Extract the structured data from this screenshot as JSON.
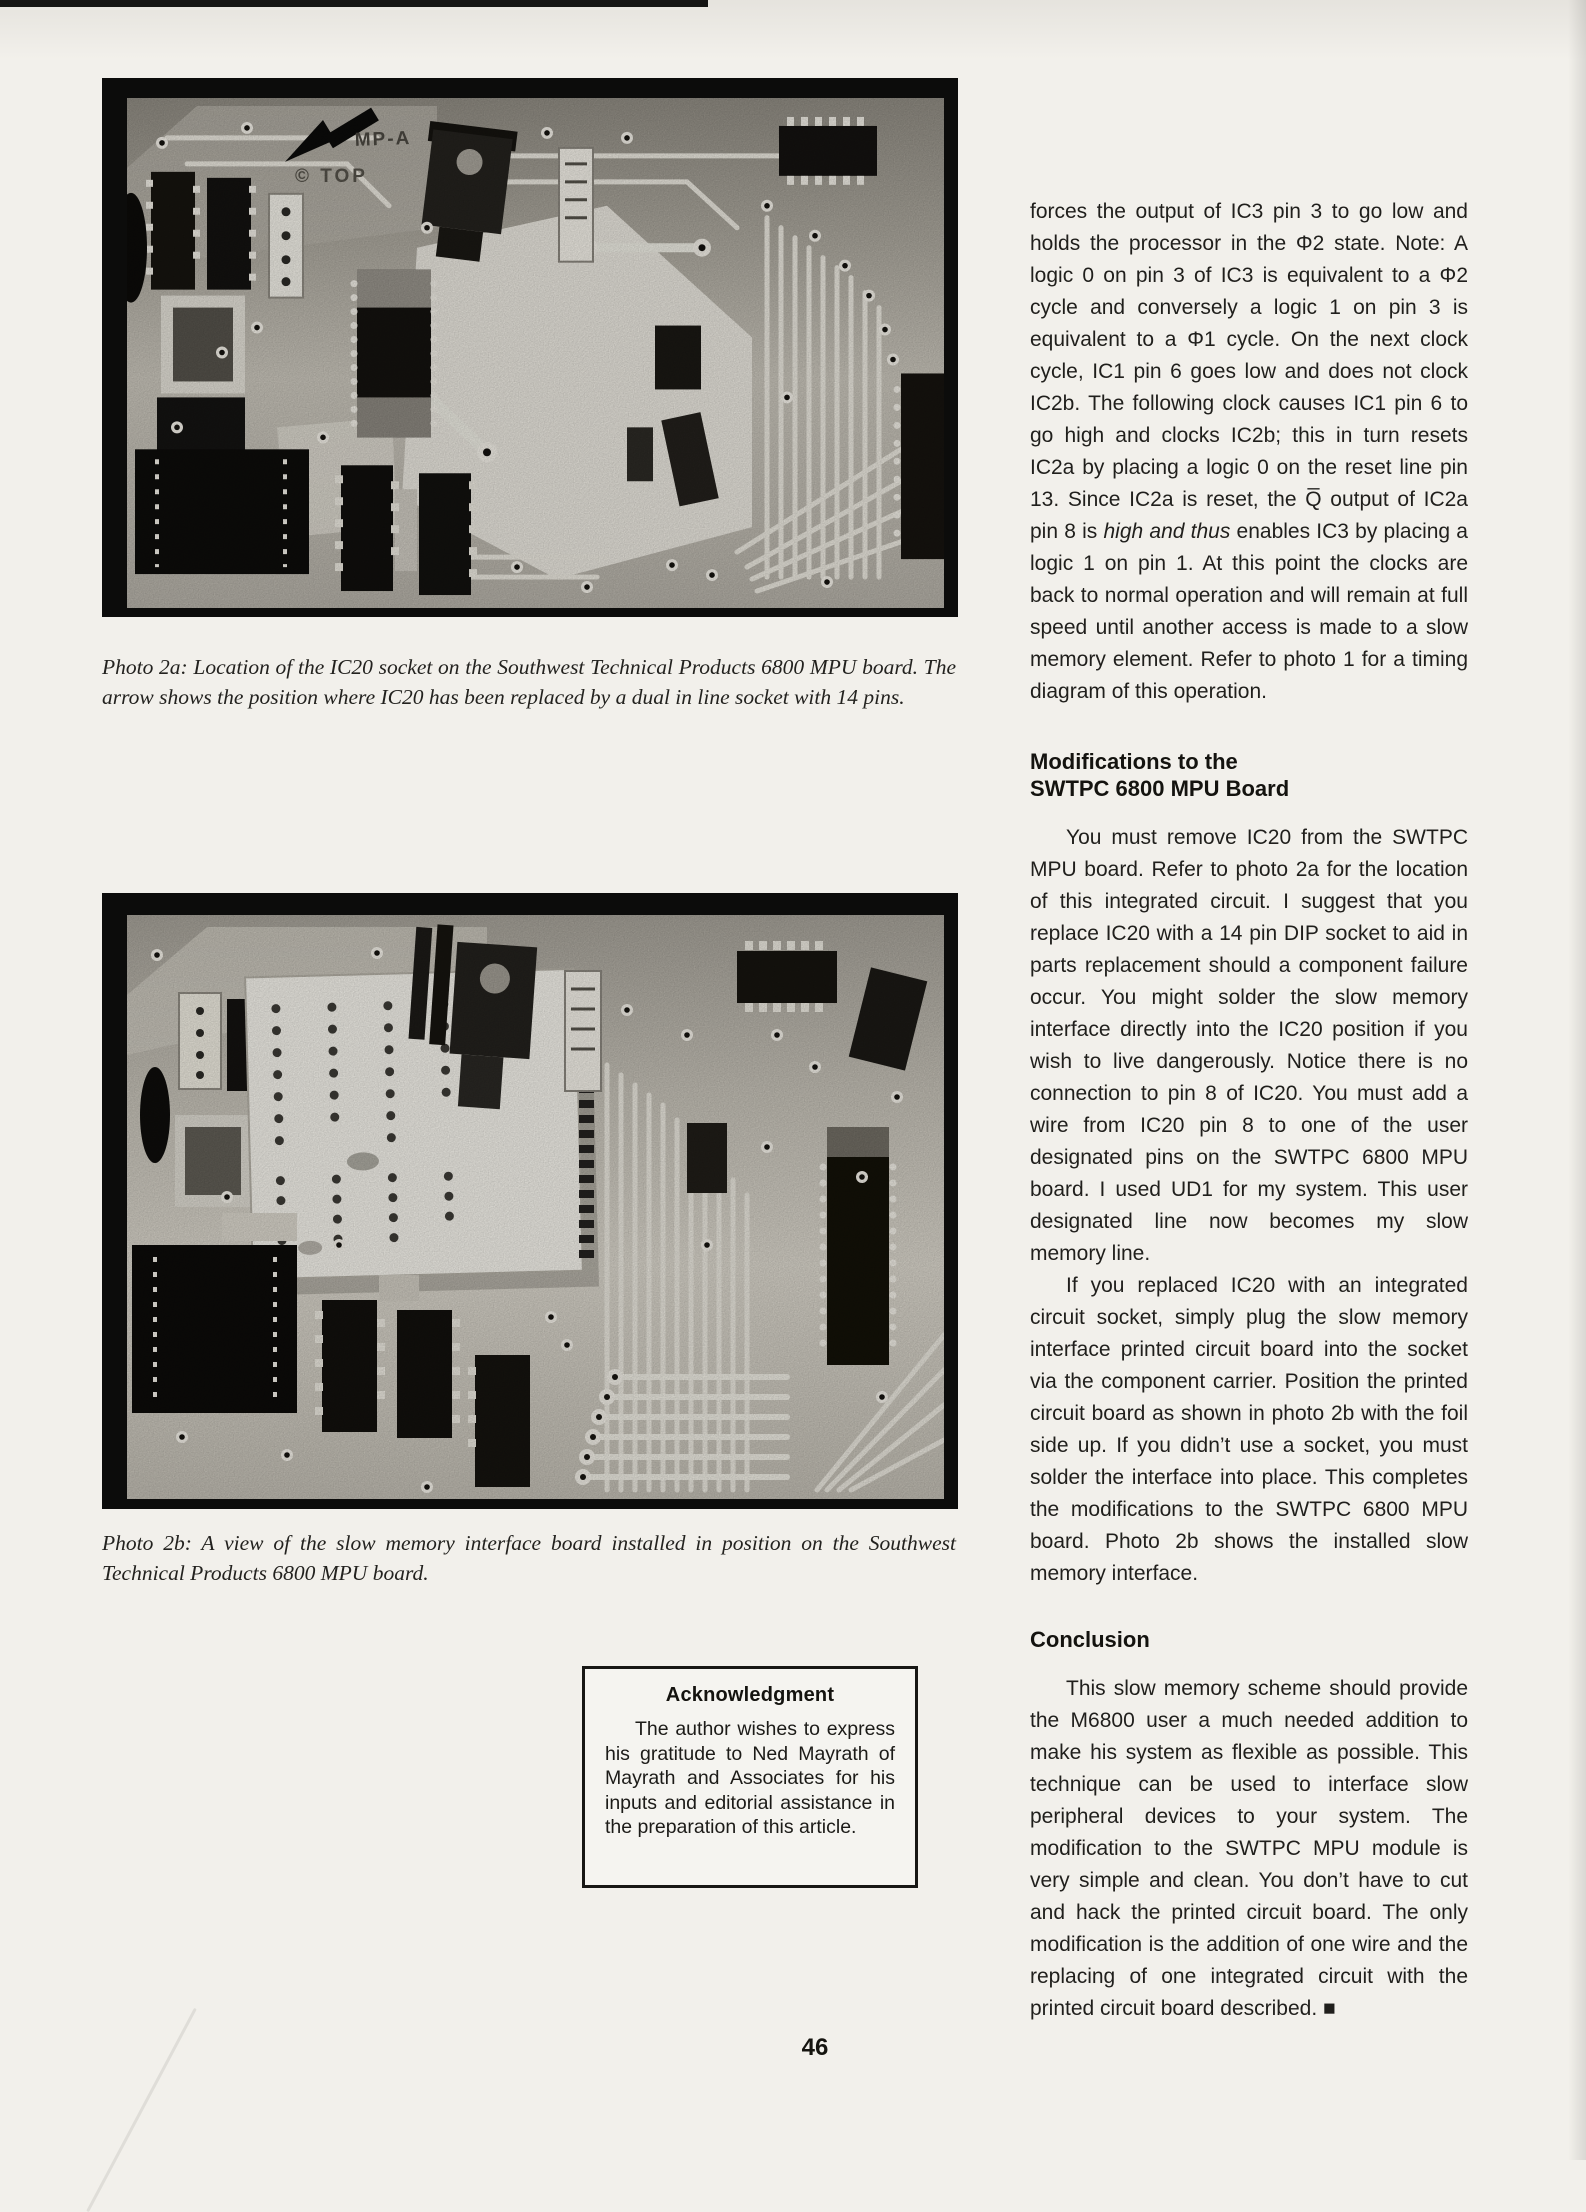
{
  "page": {
    "number": "46"
  },
  "left_column": {
    "photo_2a": {
      "caption": "Photo 2a: Location of the IC20 socket on the Southwest Technical Products 6800 MPU board. The arrow shows the position where IC20 has been replaced by a dual in line socket with 14 pins.",
      "board_label": "MP-A",
      "board_stamp": "©  TOP"
    },
    "photo_2b": {
      "caption": "Photo 2b: A view of the slow memory interface board installed in position on the Southwest Technical Products 6800 MPU board."
    },
    "acknowledgment": {
      "title": "Acknowledgment",
      "body": "The author wishes to express his gratitude to Ned Mayrath of Mayrath and Associates for his inputs and editorial assistance in the preparation of this article."
    }
  },
  "article": {
    "para_continuation_a": "forces the output of IC3 pin 3 to go low and holds the processor in the Φ2 state. Note: A logic 0 on pin 3 of IC3 is equivalent to a Φ2 cycle and conversely a logic 1 on pin 3 is equivalent to a Φ1 cycle. On the next clock cycle, IC1 pin 6 goes low and does not clock IC2b. The following clock causes IC1 pin 6 to go high and clocks IC2b; this in turn resets IC2a by placing a logic 0 on the reset line pin 13. Since IC2a is reset, the Q̅ output of IC2a pin 8 is ",
    "para_continuation_italic": "high and thus",
    "para_continuation_b": " enables IC3 by placing a logic 1 on pin 1. At this point the clocks are back to normal operation and will remain at full speed until another access is made to a slow memory element. Refer to photo 1 for a timing diagram of this operation.",
    "heading_modifications_line1": "Modifications to the",
    "heading_modifications_line2": "SWTPC 6800 MPU Board",
    "para_modifications_1": "You must remove IC20 from the SWTPC MPU board. Refer to photo 2a for the location of this integrated circuit. I suggest that you replace IC20 with a 14 pin DIP socket to aid in parts replacement should a component failure occur. You might solder the slow memory interface directly into the IC20 position if you wish to live dangerously. Notice there is no connection to pin 8 of IC20. You must add a wire from IC20 pin 8 to one of the user designated pins on the SWTPC 6800 MPU board. I used UD1 for my system. This user designated line now becomes my slow memory line.",
    "para_modifications_2": "If you replaced IC20 with an integrated circuit socket, simply plug the slow memory interface printed circuit board into the socket via the component carrier. Position the printed circuit board as shown in photo 2b with the foil side up. If you didn’t use a socket, you must solder the interface into place. This completes the modifications to the SWTPC 6800 MPU board. Photo 2b shows the installed slow memory interface.",
    "heading_conclusion": "Conclusion",
    "para_conclusion": "This slow memory scheme should provide the M6800 user a much needed addition to make his system as flexible as possible. This technique can be used to interface slow peripheral devices to your system. The modification to the SWTPC MPU module is very simple and clean. You don’t have to cut and hack the printed circuit board. The only modification is the addition of one wire and the replacing of one integrated circuit with the printed circuit board described. ■"
  }
}
